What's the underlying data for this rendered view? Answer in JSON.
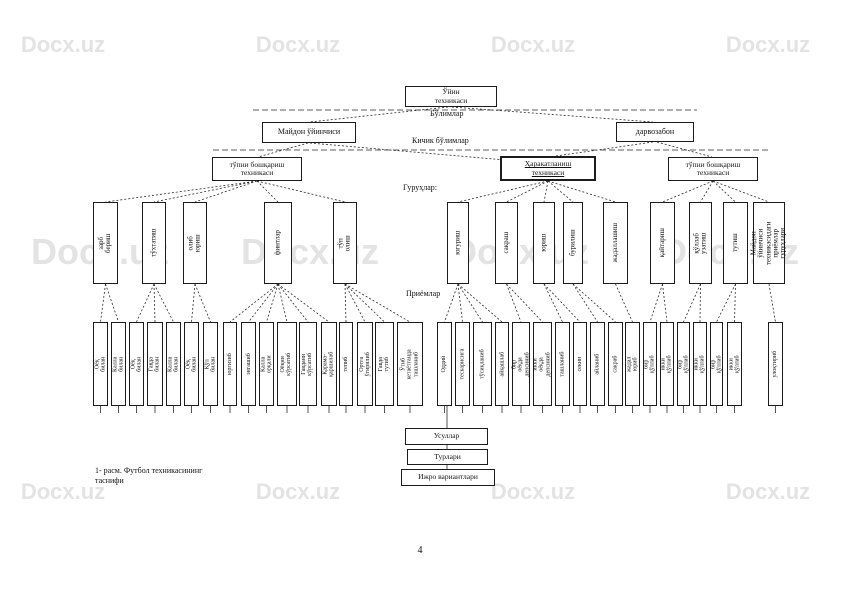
{
  "page": {
    "number": "4",
    "caption": "1- расм. Футбол техникасининг\nтаснифи"
  },
  "watermark": {
    "text": "Docx.uz",
    "color": "#c8c8c8"
  },
  "labels": {
    "level1": "Бўлимлар",
    "level2": "Кичик бўлимлар",
    "level3": "Гуруҳлар:",
    "level4": "Приёмлар"
  },
  "root": {
    "label": "Ўйин\nтехникаси"
  },
  "branches": [
    {
      "label": "Майдон ўйинчиси"
    },
    {
      "label": "дарвозабон"
    }
  ],
  "sections": [
    {
      "label": "тўпни бошқариш\nтехникаси"
    },
    {
      "label": "Ҳаракатланиш\nтехникаси"
    },
    {
      "label": "тўпни бошқариш\nтехникаси"
    }
  ],
  "groups": [
    {
      "section": 0,
      "x": 93,
      "w": 25,
      "label": "зарб бериш"
    },
    {
      "section": 0,
      "x": 142,
      "w": 24,
      "label": "тўхтатиш"
    },
    {
      "section": 0,
      "x": 183,
      "w": 24,
      "label": "олиб юриш"
    },
    {
      "section": 0,
      "x": 264,
      "w": 28,
      "label": "финтлар"
    },
    {
      "section": 0,
      "x": 333,
      "w": 24,
      "label": "тўп олиш"
    },
    {
      "section": 1,
      "x": 447,
      "w": 22,
      "label": "югуриш"
    },
    {
      "section": 1,
      "x": 495,
      "w": 23,
      "label": "сакраш"
    },
    {
      "section": 1,
      "x": 533,
      "w": 22,
      "label": "юриш"
    },
    {
      "section": 1,
      "x": 563,
      "w": 20,
      "label": "бурилиш"
    },
    {
      "section": 1,
      "x": 603,
      "w": 25,
      "label": "жадаллашиш"
    },
    {
      "section": 2,
      "x": 650,
      "w": 25,
      "label": "қайтариш"
    },
    {
      "section": 2,
      "x": 689,
      "w": 23,
      "label": "қўллаб узатиш"
    },
    {
      "section": 2,
      "x": 723,
      "w": 25,
      "label": "тутиш"
    },
    {
      "section": 2,
      "x": 753,
      "w": 32,
      "label": "Майдон ўйинчиси\nтехникасидаги\nприёмлар гуруҳлари"
    }
  ],
  "techniques": [
    {
      "group": 0,
      "x": 93,
      "w": 15,
      "label": "Оёқ билан"
    },
    {
      "group": 0,
      "x": 111,
      "w": 15,
      "label": "Калла билан"
    },
    {
      "group": 1,
      "x": 129,
      "w": 15,
      "label": "Оёқ билан"
    },
    {
      "group": 1,
      "x": 147,
      "w": 16,
      "label": "Гавда билан"
    },
    {
      "group": 1,
      "x": 166,
      "w": 15,
      "label": "Калла билан"
    },
    {
      "group": 2,
      "x": 184,
      "w": 15,
      "label": "Оёқ билан"
    },
    {
      "group": 2,
      "x": 203,
      "w": 15,
      "label": "Қўл билан"
    },
    {
      "group": 3,
      "x": 223,
      "w": 14,
      "label": "юргизиб"
    },
    {
      "group": 3,
      "x": 241,
      "w": 15,
      "label": "энгашиб"
    },
    {
      "group": 3,
      "x": 259,
      "w": 15,
      "label": "Калла орқали"
    },
    {
      "group": 3,
      "x": 277,
      "w": 20,
      "label": "Оёқни кўрсатиб"
    },
    {
      "group": 3,
      "x": 299,
      "w": 18,
      "label": "Гавдани кўрсатиб"
    },
    {
      "group": 3,
      "x": 321,
      "w": 16,
      "label": "Қарама-қаршилаб"
    },
    {
      "group": 4,
      "x": 339,
      "w": 14,
      "label": "тепиб"
    },
    {
      "group": 4,
      "x": 357,
      "w": 16,
      "label": "Ортга ўгирилиб"
    },
    {
      "group": 4,
      "x": 375,
      "w": 19,
      "label": "Гавда тутиб"
    },
    {
      "group": 4,
      "x": 397,
      "w": 26,
      "label": "Ўтиб кетаётганда\nташланиб"
    },
    {
      "group": 5,
      "x": 437,
      "w": 15,
      "label": "Оддий"
    },
    {
      "group": 5,
      "x": 455,
      "w": 15,
      "label": "тескарисига"
    },
    {
      "group": 5,
      "x": 473,
      "w": 19,
      "label": "тўсиқланиб"
    },
    {
      "group": 5,
      "x": 495,
      "w": 14,
      "label": "айқашлаб"
    },
    {
      "group": 6,
      "x": 512,
      "w": 18,
      "label": "бир оёқда\nдепсиниб"
    },
    {
      "group": 6,
      "x": 533,
      "w": 19,
      "label": "икки оёқда\nдепсиниб"
    },
    {
      "group": 7,
      "x": 555,
      "w": 15,
      "label": "ташланиб"
    },
    {
      "group": 7,
      "x": 573,
      "w": 14,
      "label": "секин"
    },
    {
      "group": 8,
      "x": 590,
      "w": 15,
      "label": "айланиб"
    },
    {
      "group": 8,
      "x": 608,
      "w": 15,
      "label": "сакраб"
    },
    {
      "group": 9,
      "x": 625,
      "w": 15,
      "label": "жадал юриб"
    },
    {
      "group": 10,
      "x": 643,
      "w": 14,
      "label": "бир қўллаб"
    },
    {
      "group": 10,
      "x": 660,
      "w": 14,
      "label": "икки қўллаб"
    },
    {
      "group": 11,
      "x": 677,
      "w": 13,
      "label": "бир қўллаб"
    },
    {
      "group": 11,
      "x": 693,
      "w": 14,
      "label": "икки қўллаб"
    },
    {
      "group": 12,
      "x": 710,
      "w": 13,
      "label": "бир қўллаб"
    },
    {
      "group": 12,
      "x": 727,
      "w": 15,
      "label": "икки қўллаб"
    },
    {
      "group": 13,
      "x": 768,
      "w": 15,
      "label": "улоқтириб"
    }
  ],
  "chain": [
    {
      "label": "Усуллар"
    },
    {
      "label": "Турлари"
    },
    {
      "label": "Ижро вариантлари"
    }
  ]
}
